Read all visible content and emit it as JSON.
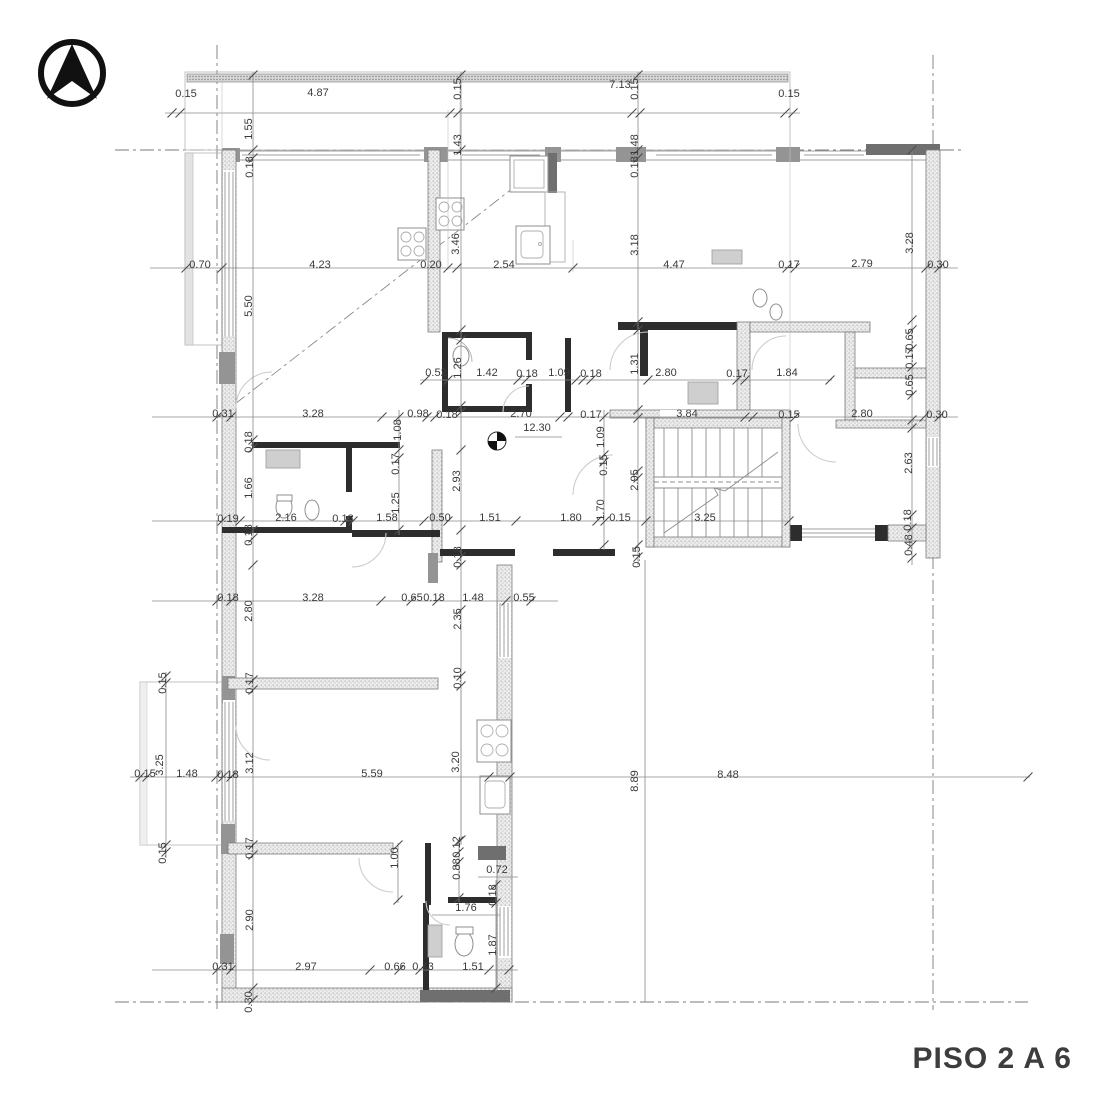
{
  "title": {
    "label": "PISO 2 A 6",
    "color": "#3d3d3d"
  },
  "compass": {
    "icon": "north-arrow-icon"
  },
  "plan": {
    "type": "floor-plan",
    "level_marker": "12.30",
    "wall_color": "#2d2d2d",
    "hatch_color": "#ececec",
    "dimensions": [
      {
        "t": "0.15",
        "x": 186,
        "y": 97,
        "r": 0
      },
      {
        "t": "4.87",
        "x": 318,
        "y": 96,
        "r": 0
      },
      {
        "t": "0.15",
        "x": 461,
        "y": 89,
        "r": -90
      },
      {
        "t": "7.13",
        "x": 620,
        "y": 88,
        "r": 0
      },
      {
        "t": "0.15",
        "x": 638,
        "y": 89,
        "r": -90
      },
      {
        "t": "0.15",
        "x": 789,
        "y": 97,
        "r": 0
      },
      {
        "t": "1.55",
        "x": 252,
        "y": 129,
        "r": -90
      },
      {
        "t": "1.43",
        "x": 461,
        "y": 145,
        "r": -90
      },
      {
        "t": "1.48",
        "x": 638,
        "y": 145,
        "r": -90
      },
      {
        "t": "0.18",
        "x": 253,
        "y": 167,
        "r": -90
      },
      {
        "t": "0.18",
        "x": 638,
        "y": 167,
        "r": -90
      },
      {
        "t": "0.70",
        "x": 200,
        "y": 268,
        "r": 0
      },
      {
        "t": "4.23",
        "x": 320,
        "y": 268,
        "r": 0
      },
      {
        "t": "0.20",
        "x": 431,
        "y": 268,
        "r": 0
      },
      {
        "t": "2.54",
        "x": 504,
        "y": 268,
        "r": 0
      },
      {
        "t": "4.47",
        "x": 674,
        "y": 268,
        "r": 0
      },
      {
        "t": "0.17",
        "x": 789,
        "y": 268,
        "r": 0
      },
      {
        "t": "2.79",
        "x": 862,
        "y": 267,
        "r": 0
      },
      {
        "t": "0.30",
        "x": 938,
        "y": 268,
        "r": 0
      },
      {
        "t": "5.50",
        "x": 252,
        "y": 306,
        "r": -90
      },
      {
        "t": "3.46",
        "x": 459,
        "y": 244,
        "r": -90
      },
      {
        "t": "3.18",
        "x": 638,
        "y": 245,
        "r": -90
      },
      {
        "t": "3.28",
        "x": 913,
        "y": 243,
        "r": -90
      },
      {
        "t": "0.52",
        "x": 436,
        "y": 376,
        "r": 0
      },
      {
        "t": "1.26",
        "x": 461,
        "y": 368,
        "r": -90
      },
      {
        "t": "1.42",
        "x": 487,
        "y": 376,
        "r": 0
      },
      {
        "t": "0.18",
        "x": 527,
        "y": 377,
        "r": 0
      },
      {
        "t": "1.09",
        "x": 559,
        "y": 376,
        "r": 0
      },
      {
        "t": "0.18",
        "x": 591,
        "y": 377,
        "r": 0
      },
      {
        "t": "1.31",
        "x": 638,
        "y": 364,
        "r": -90
      },
      {
        "t": "2.80",
        "x": 666,
        "y": 376,
        "r": 0
      },
      {
        "t": "0.17",
        "x": 737,
        "y": 377,
        "r": 0
      },
      {
        "t": "1.84",
        "x": 787,
        "y": 376,
        "r": 0
      },
      {
        "t": "0.65",
        "x": 913,
        "y": 339,
        "r": -90
      },
      {
        "t": "0.17",
        "x": 913,
        "y": 358,
        "r": -90
      },
      {
        "t": "0.65",
        "x": 913,
        "y": 385,
        "r": -90
      },
      {
        "t": "0.31",
        "x": 223,
        "y": 417,
        "r": 0
      },
      {
        "t": "3.28",
        "x": 313,
        "y": 417,
        "r": 0
      },
      {
        "t": "0.98",
        "x": 418,
        "y": 417,
        "r": 0
      },
      {
        "t": "0.18",
        "x": 447,
        "y": 418,
        "r": 0
      },
      {
        "t": "2.70",
        "x": 521,
        "y": 417,
        "r": 0
      },
      {
        "t": "0.17",
        "x": 591,
        "y": 418,
        "r": 0
      },
      {
        "t": "3.84",
        "x": 687,
        "y": 417,
        "r": 0
      },
      {
        "t": "0.15",
        "x": 789,
        "y": 418,
        "r": 0
      },
      {
        "t": "2.80",
        "x": 862,
        "y": 417,
        "r": 0
      },
      {
        "t": "0.30",
        "x": 937,
        "y": 418,
        "r": 0
      },
      {
        "t": "1.08",
        "x": 401,
        "y": 430,
        "r": -90
      },
      {
        "t": "12.30",
        "x": 537,
        "y": 431,
        "r": 0
      },
      {
        "t": "1.09",
        "x": 604,
        "y": 437,
        "r": -90
      },
      {
        "t": "0.18",
        "x": 252,
        "y": 442,
        "r": -90
      },
      {
        "t": "0.17",
        "x": 399,
        "y": 464,
        "r": -90
      },
      {
        "t": "2.93",
        "x": 460,
        "y": 481,
        "r": -90
      },
      {
        "t": "0.15",
        "x": 607,
        "y": 465,
        "r": -90
      },
      {
        "t": "2.95",
        "x": 638,
        "y": 480,
        "r": -90
      },
      {
        "t": "2.63",
        "x": 912,
        "y": 463,
        "r": -90
      },
      {
        "t": "1.66",
        "x": 252,
        "y": 488,
        "r": -90
      },
      {
        "t": "1.25",
        "x": 399,
        "y": 503,
        "r": -90
      },
      {
        "t": "1.70",
        "x": 604,
        "y": 510,
        "r": -90
      },
      {
        "t": "0.19",
        "x": 228,
        "y": 522,
        "r": 0
      },
      {
        "t": "2.16",
        "x": 286,
        "y": 521,
        "r": 0
      },
      {
        "t": "0.18",
        "x": 343,
        "y": 522,
        "r": 0
      },
      {
        "t": "1.58",
        "x": 387,
        "y": 521,
        "r": 0
      },
      {
        "t": "0.50",
        "x": 440,
        "y": 521,
        "r": 0
      },
      {
        "t": "1.51",
        "x": 490,
        "y": 521,
        "r": 0
      },
      {
        "t": "1.80",
        "x": 571,
        "y": 521,
        "r": 0
      },
      {
        "t": "0.15",
        "x": 620,
        "y": 521,
        "r": 0
      },
      {
        "t": "3.25",
        "x": 705,
        "y": 521,
        "r": 0
      },
      {
        "t": "0.18",
        "x": 911,
        "y": 520,
        "r": -90
      },
      {
        "t": "0.48",
        "x": 912,
        "y": 545,
        "r": -90
      },
      {
        "t": "0.18",
        "x": 252,
        "y": 535,
        "r": -90
      },
      {
        "t": "0.18",
        "x": 461,
        "y": 557,
        "r": -90
      },
      {
        "t": "0.15",
        "x": 640,
        "y": 557,
        "r": -90
      },
      {
        "t": "0.18",
        "x": 228,
        "y": 601,
        "r": 0
      },
      {
        "t": "3.28",
        "x": 313,
        "y": 601,
        "r": 0
      },
      {
        "t": "0.65",
        "x": 412,
        "y": 601,
        "r": 0
      },
      {
        "t": "0.18",
        "x": 434,
        "y": 601,
        "r": 0
      },
      {
        "t": "1.48",
        "x": 473,
        "y": 601,
        "r": 0
      },
      {
        "t": "0.55",
        "x": 524,
        "y": 601,
        "r": 0
      },
      {
        "t": "2.80",
        "x": 252,
        "y": 611,
        "r": -90
      },
      {
        "t": "2.35",
        "x": 461,
        "y": 619,
        "r": -90
      },
      {
        "t": "0.10",
        "x": 461,
        "y": 678,
        "r": -90
      },
      {
        "t": "0.15",
        "x": 166,
        "y": 683,
        "r": -90
      },
      {
        "t": "0.17",
        "x": 253,
        "y": 683,
        "r": -90
      },
      {
        "t": "3.25",
        "x": 163,
        "y": 765,
        "r": -90
      },
      {
        "t": "3.12",
        "x": 253,
        "y": 763,
        "r": -90
      },
      {
        "t": "3.20",
        "x": 459,
        "y": 762,
        "r": -90
      },
      {
        "t": "0.15",
        "x": 145,
        "y": 777,
        "r": 0
      },
      {
        "t": "1.48",
        "x": 187,
        "y": 777,
        "r": 0
      },
      {
        "t": "0.18",
        "x": 228,
        "y": 778,
        "r": 0
      },
      {
        "t": "5.59",
        "x": 372,
        "y": 777,
        "r": 0
      },
      {
        "t": "8.89",
        "x": 638,
        "y": 781,
        "r": -90
      },
      {
        "t": "8.48",
        "x": 728,
        "y": 778,
        "r": 0
      },
      {
        "t": "0.15",
        "x": 166,
        "y": 853,
        "r": -90
      },
      {
        "t": "0.17",
        "x": 253,
        "y": 848,
        "r": -90
      },
      {
        "t": "1.00",
        "x": 398,
        "y": 858,
        "r": -90
      },
      {
        "t": "0.12",
        "x": 460,
        "y": 847,
        "r": -90
      },
      {
        "t": "0.88",
        "x": 460,
        "y": 869,
        "r": -90
      },
      {
        "t": "0.72",
        "x": 497,
        "y": 873,
        "r": 0
      },
      {
        "t": "0.18",
        "x": 496,
        "y": 895,
        "r": -90
      },
      {
        "t": "1.76",
        "x": 466,
        "y": 911,
        "r": 0
      },
      {
        "t": "2.90",
        "x": 253,
        "y": 920,
        "r": -90
      },
      {
        "t": "1.87",
        "x": 496,
        "y": 945,
        "r": -90
      },
      {
        "t": "0.31",
        "x": 223,
        "y": 970,
        "r": 0
      },
      {
        "t": "2.97",
        "x": 306,
        "y": 970,
        "r": 0
      },
      {
        "t": "0.66",
        "x": 395,
        "y": 970,
        "r": 0
      },
      {
        "t": "0.43",
        "x": 423,
        "y": 970,
        "r": 0
      },
      {
        "t": "1.51",
        "x": 473,
        "y": 970,
        "r": 0
      },
      {
        "t": "0.30",
        "x": 252,
        "y": 1002,
        "r": -90
      }
    ]
  }
}
